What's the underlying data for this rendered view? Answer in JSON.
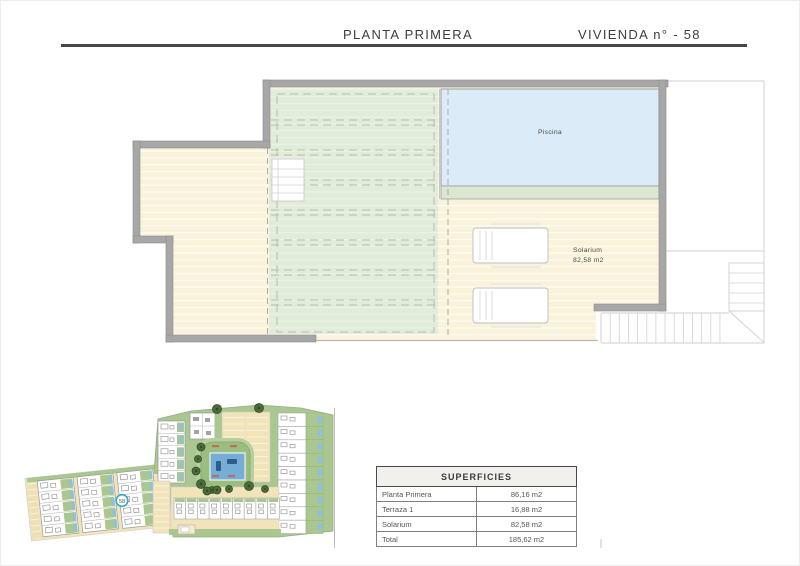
{
  "header": {
    "left_title": "PLANTA PRIMERA",
    "right_title": "VIVIENDA n° - 58"
  },
  "floor_plan": {
    "pool_label": "Piscina",
    "solarium_label": "Solarium",
    "solarium_area": "82,58 m2"
  },
  "site_plan": {
    "unit_marker": "58"
  },
  "table": {
    "title": "SUPERFICIES",
    "rows": [
      {
        "label": "Planta Primera",
        "value": "86,16 m2"
      },
      {
        "label": "Terraza 1",
        "value": "16,88 m2"
      },
      {
        "label": "Solarium",
        "value": "82,58 m2"
      },
      {
        "label": "Total",
        "value": "185,62 m2"
      }
    ]
  },
  "colors": {
    "wall_gray": "#a7a7a7",
    "pool_blue": "#dcebf8",
    "pergola_green": "#e1ecda",
    "deck_cream": "#faf3dc",
    "site_green": "#abc791",
    "site_road": "#f2e4ba",
    "site_pool": "#76add4",
    "marker_teal": "#35a9c8"
  }
}
